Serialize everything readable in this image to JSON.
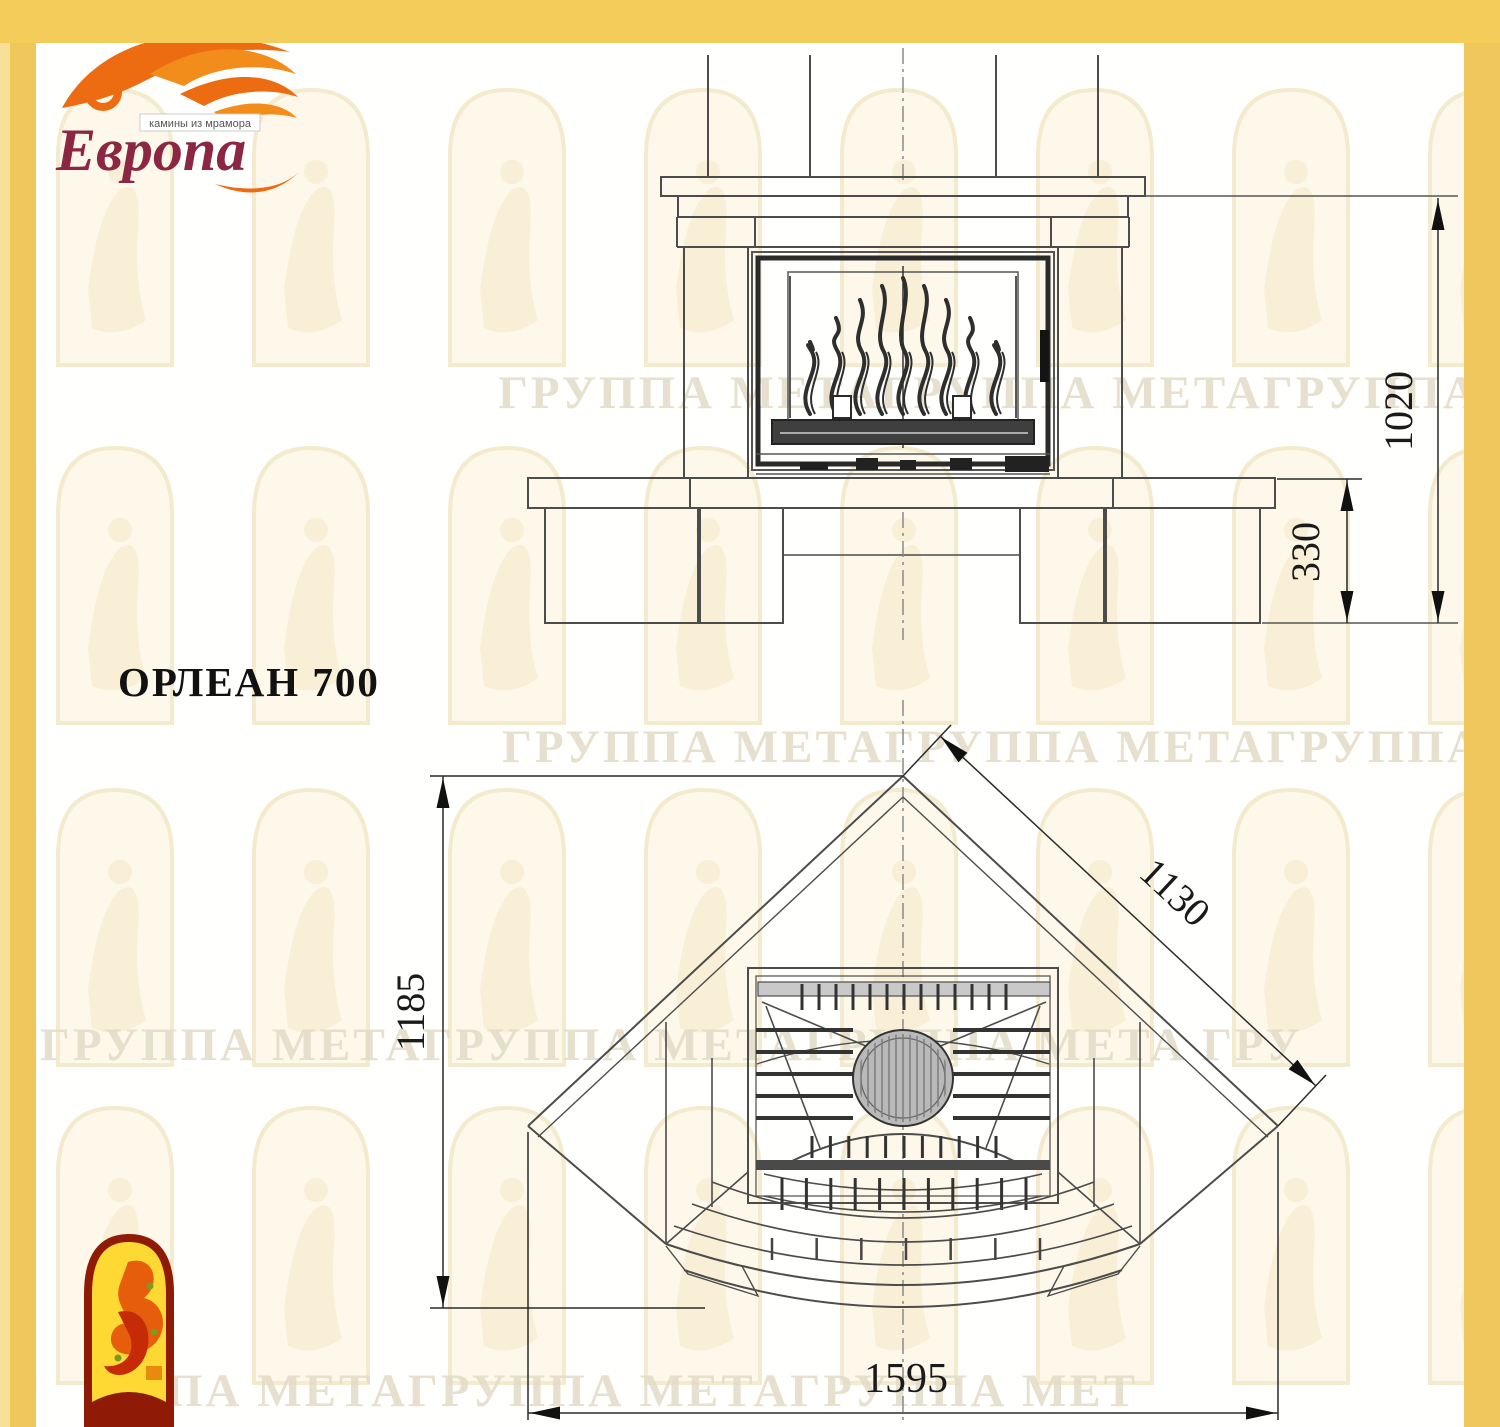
{
  "brand": {
    "name": "Европа",
    "tagline": "камины из мрамора",
    "flame_color": "#ED6C12",
    "name_color": "#8B2742",
    "border_color": "#F2C95C"
  },
  "title": "ОРЛЕАН 700",
  "watermark": {
    "row1": "ГРУППА МЕТАГРУППА МЕТАГРУППА МЕТ",
    "row2": "ГРУППА МЕТАГРУППА МЕТАГРУППА МЕТА",
    "row3": "ГРУППА МЕТАГРУППА МЕТАГРУППА МЕТА ГРУ",
    "row4": "ПА МЕТАГРУППА МЕТАГРУППА МЕТ"
  },
  "front_view": {
    "dim_total_height": "1020",
    "dim_hearth_height": "330"
  },
  "plan_view": {
    "dim_depth": "1185",
    "dim_side": "1130",
    "dim_width": "1595"
  }
}
